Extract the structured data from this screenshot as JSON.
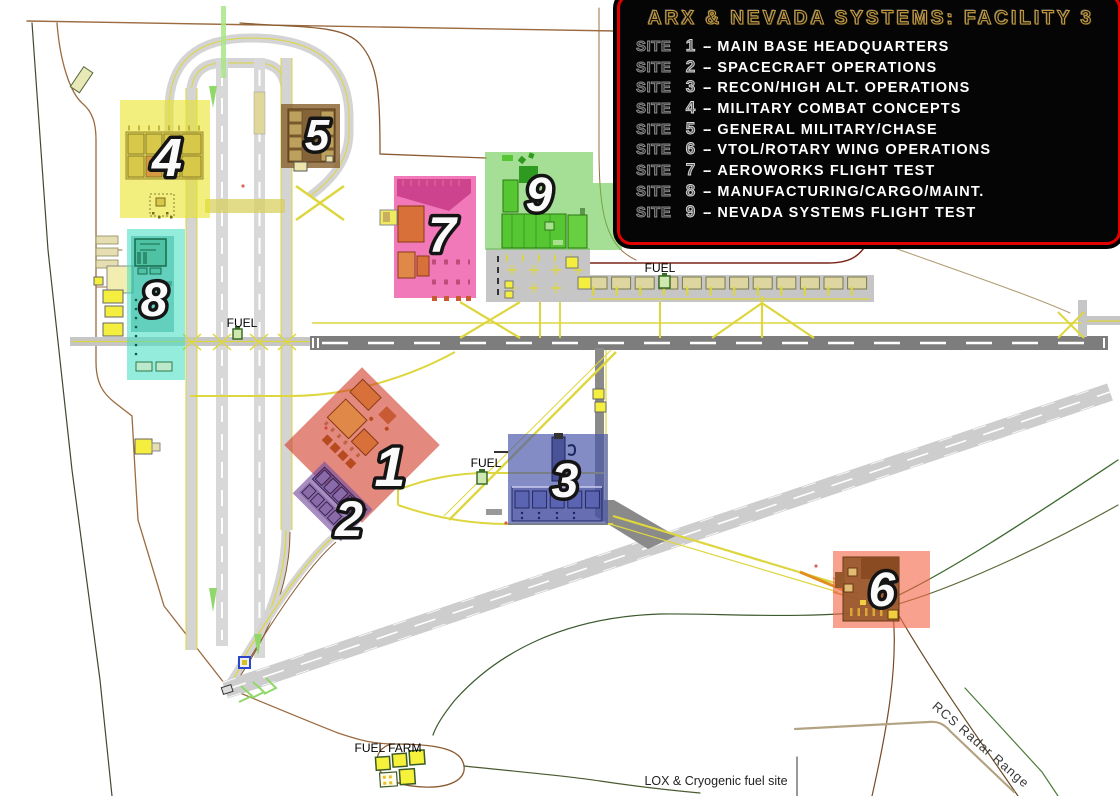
{
  "legend": {
    "title": "ARX & NEVADA SYSTEMS: FACILITY 3",
    "site_word": "SITE",
    "separator": "--",
    "border_color": "#e10000",
    "title_color": "#c49a3e",
    "entries": [
      {
        "num": "1",
        "desc": "MAIN BASE HEADQUARTERS"
      },
      {
        "num": "2",
        "desc": "SPACECRAFT OPERATIONS"
      },
      {
        "num": "3",
        "desc": "RECON/HIGH ALT. OPERATIONS"
      },
      {
        "num": "4",
        "desc": "MILITARY COMBAT CONCEPTS"
      },
      {
        "num": "5",
        "desc": "GENERAL MILITARY/CHASE"
      },
      {
        "num": "6",
        "desc": "VTOL/ROTARY WING OPERATIONS"
      },
      {
        "num": "7",
        "desc": "AEROWORKS FLIGHT TEST"
      },
      {
        "num": "8",
        "desc": "MANUFACTURING/CARGO/MAINT."
      },
      {
        "num": "9",
        "desc": "NEVADA SYSTEMS FLIGHT TEST"
      }
    ]
  },
  "map": {
    "labels": {
      "fuel_west": "FUEL",
      "fuel_north": "FUEL",
      "fuel_center": "FUEL",
      "fuel_farm": "FUEL FARM",
      "lox": "LOX & Cryogenic fuel site",
      "rcs": "RCS Radar Range"
    },
    "sites": [
      {
        "num": "1",
        "color": "#d03a28"
      },
      {
        "num": "2",
        "color": "#7a50a0"
      },
      {
        "num": "3",
        "color": "#4a55aa"
      },
      {
        "num": "4",
        "color": "#e8e322"
      },
      {
        "num": "5",
        "color": "#8a6330"
      },
      {
        "num": "6",
        "color": "#f26848"
      },
      {
        "num": "7",
        "color": "#e8258e"
      },
      {
        "num": "8",
        "color": "#46dfc3"
      },
      {
        "num": "9",
        "color": "#62c848"
      }
    ]
  }
}
